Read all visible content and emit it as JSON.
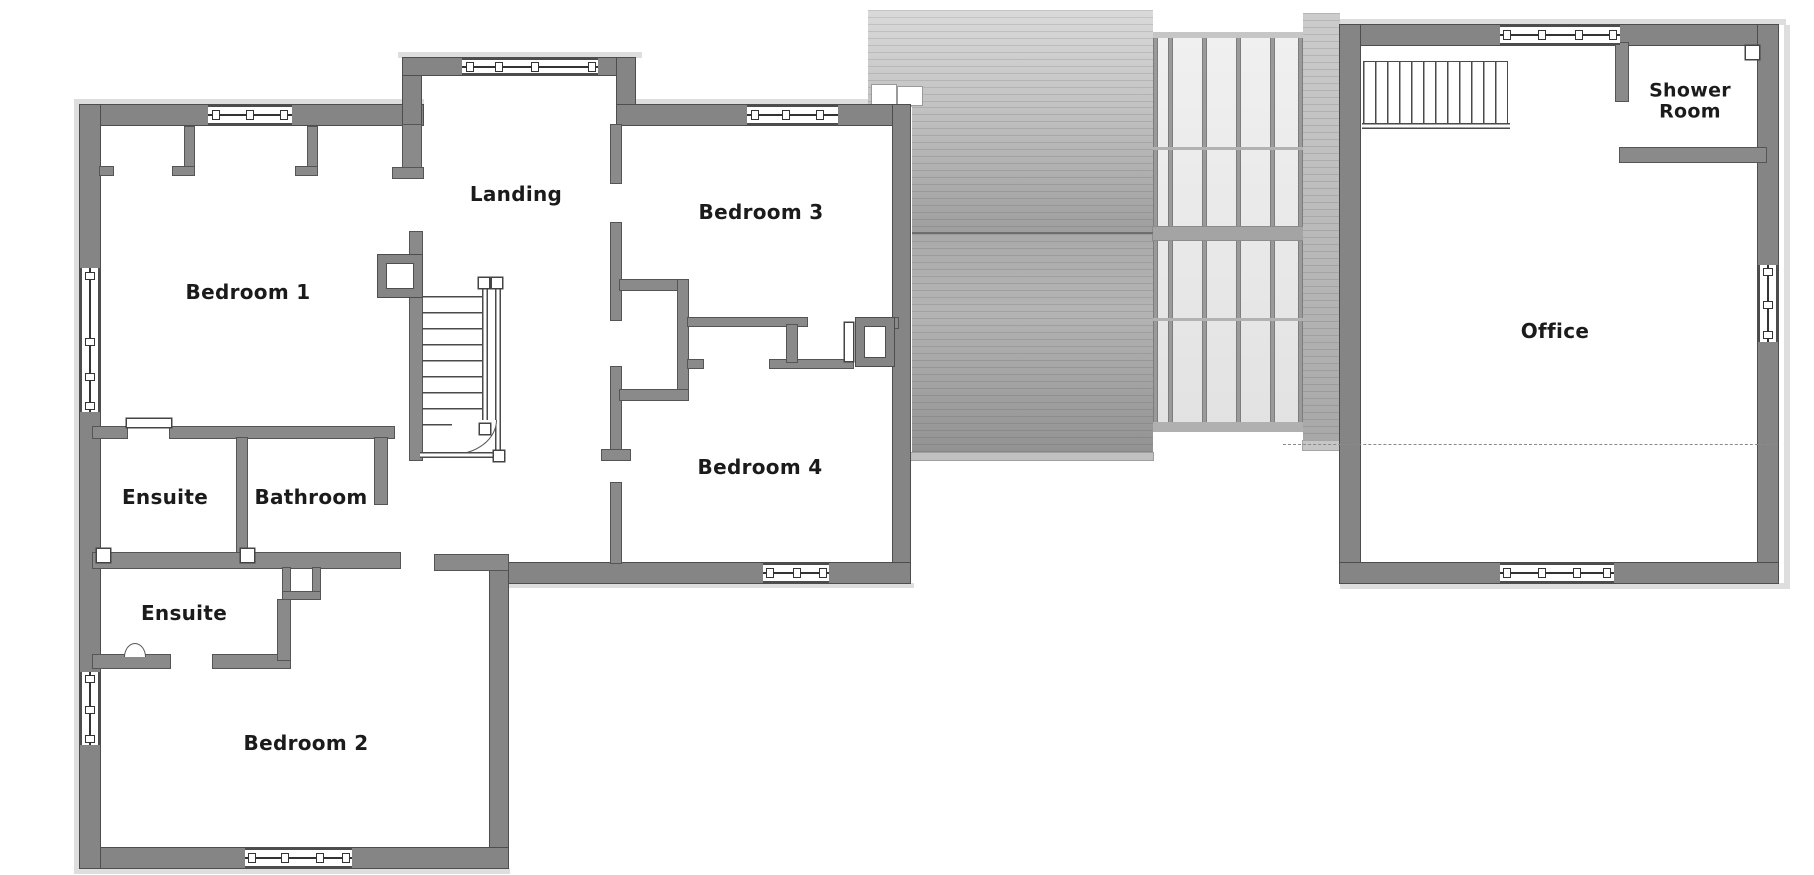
{
  "rooms": {
    "bedroom1": {
      "label": "Bedroom 1"
    },
    "landing": {
      "label": "Landing"
    },
    "bedroom3": {
      "label": "Bedroom 3"
    },
    "bedroom4": {
      "label": "Bedroom 4"
    },
    "ensuite_top": {
      "label": "Ensuite"
    },
    "bathroom": {
      "label": "Bathroom"
    },
    "ensuite_mid": {
      "label": "Ensuite"
    },
    "bedroom2": {
      "label": "Bedroom 2"
    },
    "office": {
      "label": "Office"
    },
    "shower_room": {
      "label": "Shower Room"
    }
  },
  "colors": {
    "wall": "#858585",
    "wall_outline": "#4d4d4d",
    "roof_light": "#d9d9d9",
    "roof_dark": "#949494",
    "glass": "#ececec",
    "shadow_band": "#dedede",
    "text": "#1b1b1b"
  }
}
